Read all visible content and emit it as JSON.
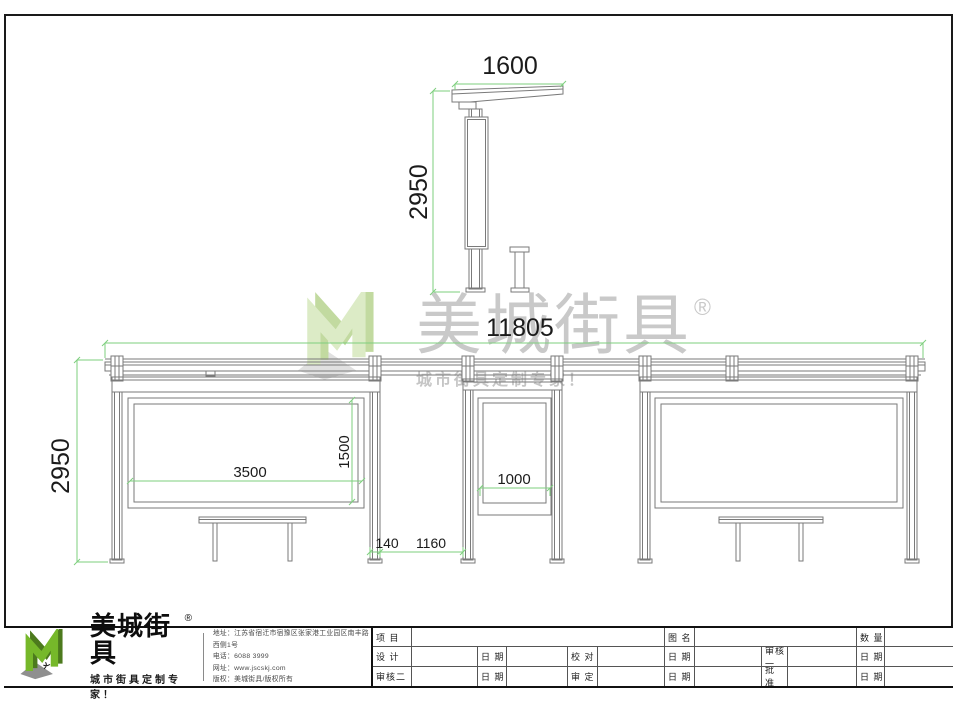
{
  "watermark": {
    "brand": "美城街具",
    "reg": "®",
    "tagline": "城市街具定制专家！"
  },
  "drawings": {
    "side_view": {
      "dim_width": "1600",
      "dim_height": "2950"
    },
    "front_view": {
      "dim_total_width": "11805",
      "dim_height": "2950",
      "dim_left_panel_width": "3500",
      "dim_panel_height": "1500",
      "dim_mid_panel_width": "1000",
      "dim_post_width": "140",
      "dim_bay_gap": "1160"
    }
  },
  "logo_block": {
    "brand": "美城街具",
    "reg": "®",
    "tagline": "城市街具定制专家！",
    "contact": {
      "line1": "地址：江苏省宿迁市宿豫区张家港工业园区南丰路西侧1号",
      "line2": "电话：6088 3999",
      "line3": "网址：www.jscskj.com",
      "line4": "版权：美城街具/版权所有"
    }
  },
  "titleblock": {
    "row1": [
      "项 目",
      "",
      "图 名",
      "",
      "数 量",
      ""
    ],
    "row2": [
      "设 计",
      "",
      "日 期",
      "",
      "校 对",
      "",
      "日 期",
      "",
      "审核一",
      "",
      "日 期",
      ""
    ],
    "row3": [
      "审核二",
      "",
      "日 期",
      "",
      "审 定",
      "",
      "日 期",
      "",
      "批 准",
      "",
      "日 期",
      ""
    ]
  },
  "colors": {
    "dimension_green": "#7ecf7e",
    "linework_gray": "#7a7a7a",
    "logo_green": "#76b82a",
    "logo_green_dark": "#4c7a1d",
    "watermark_text": "#c9c9c9"
  }
}
